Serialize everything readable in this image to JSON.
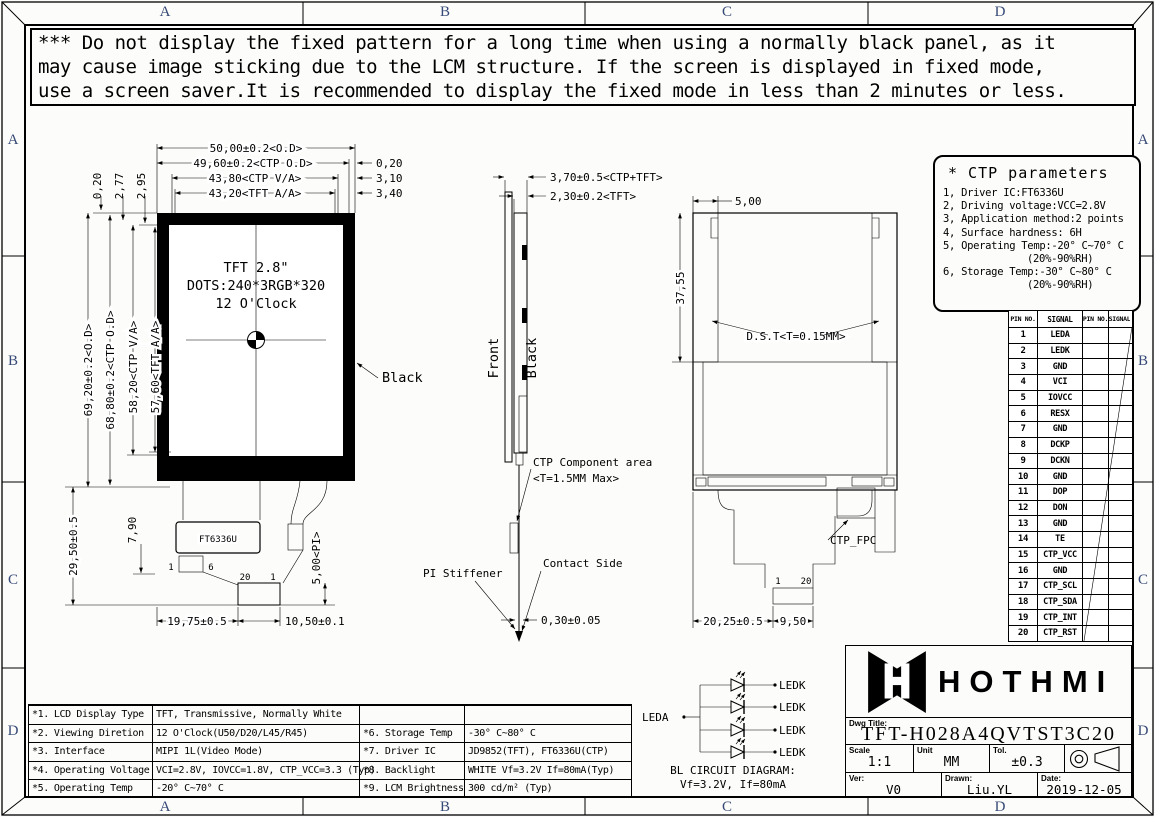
{
  "zones": {
    "top": [
      "A",
      "B",
      "C",
      "D"
    ],
    "bottom": [
      "A",
      "B",
      "C",
      "D"
    ],
    "left": [
      "A",
      "B",
      "C",
      "D"
    ],
    "right": [
      "A",
      "B",
      "C",
      "D"
    ]
  },
  "warning": {
    "line1": "*** Do not display the fixed pattern for a long time when using a normally black panel, as it",
    "line2": "may cause image sticking due to the LCM structure.  If the screen is displayed in fixed mode,",
    "line3": "use a screen saver.It is recommended to display the fixed mode in less than 2 minutes or less."
  },
  "front_view": {
    "display": [
      "TFT 2.8\"",
      "DOTS:240*3RGB*320",
      "12 O'Clock"
    ],
    "dims_top": [
      "50,00±0.2<O.D>",
      "49,60±0.2<CTP O.D>",
      "43,80<CTP V/A>",
      "43,20<TFT A/A>"
    ],
    "dims_right": [
      "0,20",
      "3,10",
      "3,40"
    ],
    "dims_topleft": [
      "0,20",
      "2,77",
      "2,95"
    ],
    "dims_left": [
      "69,20±0.2<O.D>",
      "68,80±0.2<CTP O.D>",
      "58,20<CTP V/A>",
      "57,60<TFT A/A>"
    ],
    "dim_29_50": "29,50±0.5",
    "dim_7_90": "7,90",
    "dim_5_00": "5,00<PI>",
    "dim_19_75": "19,75±0.5",
    "dim_10_50": "10,50±0.1",
    "black_label": "Black",
    "chip_label": "FT6336U",
    "pins": {
      "p1": "1",
      "p6": "6",
      "p20": "20",
      "p1b": "1"
    }
  },
  "side_view": {
    "dim1": "3,70±0.5<CTP+TFT>",
    "dim2": "2,30±0.2<TFT>",
    "front_label": "Front",
    "black_label": "Black",
    "ctp_area1": "CTP Component area",
    "ctp_area2": "<T=1.5MM Max>",
    "pi_stiffener": "PI Stiffener",
    "contact_side": "Contact Side",
    "dim_bottom": "0,30±0.05"
  },
  "back_view": {
    "dim_top": "5,00",
    "dim_left": "37,55",
    "dst": "D.S.T<T=0.15MM>",
    "ctp_fpc": "CTP_FPC",
    "pin1": "1",
    "pin20": "20",
    "dim_20_25": "20,25±0.5",
    "dim_9_50": "9,50"
  },
  "ctp_parameters": {
    "title": "* CTP parameters",
    "lines": [
      "1, Driver IC:FT6336U",
      "2, Driving voltage:VCC=2.8V",
      "3, Application method:2 points",
      "4, Surface hardness: 6H",
      "5, Operating Temp:-20° C~70° C",
      "(20%-90%RH)",
      "6, Storage Temp:-30° C~80° C",
      "(20%-90%RH)"
    ]
  },
  "pin_table": {
    "headers": [
      "PIN NO.",
      "SIGNAL",
      "PIN NO.",
      "SIGNAL"
    ],
    "rows": [
      [
        "1",
        "LEDA"
      ],
      [
        "2",
        "LEDK"
      ],
      [
        "3",
        "GND"
      ],
      [
        "4",
        "VCI"
      ],
      [
        "5",
        "IOVCC"
      ],
      [
        "6",
        "RESX"
      ],
      [
        "7",
        "GND"
      ],
      [
        "8",
        "DCKP"
      ],
      [
        "9",
        "DCKN"
      ],
      [
        "10",
        "GND"
      ],
      [
        "11",
        "DOP"
      ],
      [
        "12",
        "DON"
      ],
      [
        "13",
        "GND"
      ],
      [
        "14",
        "TE"
      ],
      [
        "15",
        "CTP_VCC"
      ],
      [
        "16",
        "GND"
      ],
      [
        "17",
        "CTP_SCL"
      ],
      [
        "18",
        "CTP_SDA"
      ],
      [
        "19",
        "CTP_INT"
      ],
      [
        "20",
        "CTP_RST"
      ]
    ]
  },
  "spec_table": {
    "rows": [
      {
        "no1": "*1.",
        "label1": "LCD Display Type",
        "val1": "TFT, Transmissive, Normally White",
        "no2": "",
        "label2": "",
        "val2": ""
      },
      {
        "no1": "*2.",
        "label1": "Viewing Diretion",
        "val1": "12 O'Clock(U50/D20/L45/R45)",
        "no2": "*6.",
        "label2": "Storage Temp",
        "val2": "-30° C~80° C"
      },
      {
        "no1": "*3.",
        "label1": "Interface",
        "val1": "MIPI 1L(Video Mode)",
        "no2": "*7.",
        "label2": "Driver IC",
        "val2": "JD9852(TFT), FT6336U(CTP)"
      },
      {
        "no1": "*4.",
        "label1": "Operating Voltage",
        "val1": "VCI=2.8V, IOVCC=1.8V, CTP_VCC=3.3 (Typ)",
        "no2": "*8.",
        "label2": "Backlight",
        "val2": "WHITE Vf=3.2V If=80mA(Typ)"
      },
      {
        "no1": "*5.",
        "label1": "Operating Temp",
        "val1": "-20° C~70° C",
        "no2": "*9.",
        "label2": "LCM Brightness",
        "val2": "300 cd/m² (Typ)"
      }
    ]
  },
  "bl_circuit": {
    "leda": "LEDA",
    "ledk": [
      "LEDK",
      "LEDK",
      "LEDK",
      "LEDK"
    ],
    "caption1": "BL CIRCUIT DIAGRAM:",
    "caption2": "Vf=3.2V, If=80mA"
  },
  "title_block": {
    "brand": "HOTHMI",
    "dwg_title_label": "Dwg Title:",
    "dwg_title": "TFT-H028A4QVTST3C20",
    "scale_label": "Scale",
    "scale": "1:1",
    "unit_label": "Unit",
    "unit": "MM",
    "tol_label": "Tol.",
    "tol": "±0.3",
    "ver_label": "Ver:",
    "ver": "V0",
    "drawn_label": "Drawn:",
    "drawn": "Liu.YL",
    "date_label": "Date:",
    "date": "2019-12-05"
  }
}
